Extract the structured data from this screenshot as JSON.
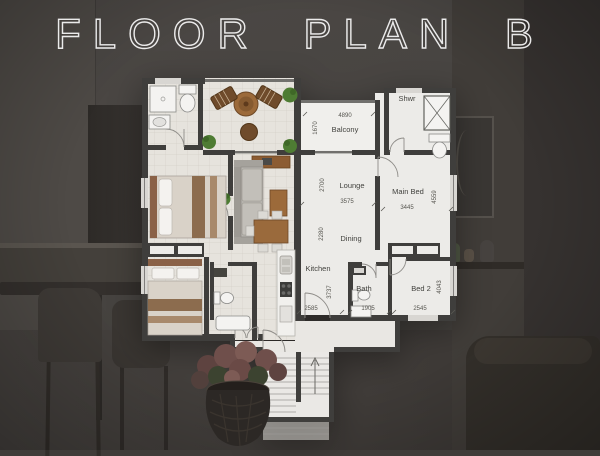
{
  "title": "FLOOR PLAN B",
  "floor_plan": {
    "rooms": {
      "balcony": {
        "label": "Balcony",
        "width": "4890",
        "depth": "1670"
      },
      "lounge": {
        "label": "Lounge",
        "width": "3575",
        "depth": "2700"
      },
      "main_bed": {
        "label": "Main Bed",
        "width": "3445",
        "depth": "4559"
      },
      "shower": {
        "label": "Shwr"
      },
      "dining": {
        "label": "Dining",
        "depth": "2280"
      },
      "kitchen": {
        "label": "Kitchen",
        "width": "2585",
        "depth": "3737"
      },
      "bath": {
        "label": "Bath",
        "width": "1905"
      },
      "bed2": {
        "label": "Bed 2",
        "width": "2545",
        "depth": "4043"
      }
    },
    "colors": {
      "wall": "#3f3e3c",
      "line_floor": "#ecebe8",
      "furnished_floor": "#e6e3dd",
      "wood_accent": "#9c6a3a",
      "plant_green": "#4e7c33",
      "title_stroke": "#fafafa",
      "photo_overlay": "#3e3b37"
    }
  }
}
